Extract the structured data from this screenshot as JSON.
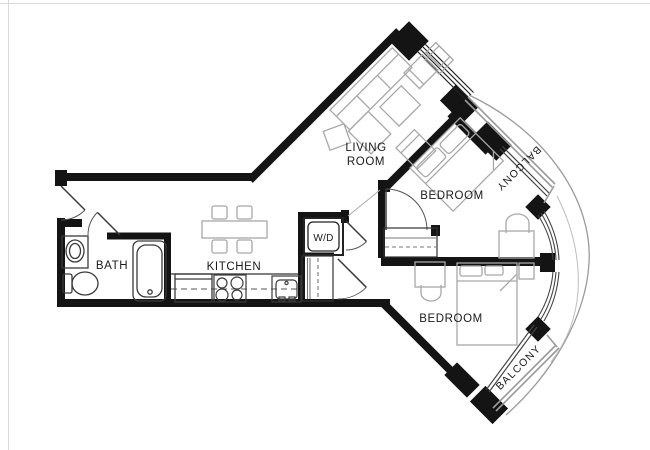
{
  "document": {
    "type": "apartment-floor-plan"
  },
  "labels": {
    "bath": "BATH",
    "kitchen": "KITCHEN",
    "washer_dryer": "W/D",
    "living_room_line1": "LIVING",
    "living_room_line2": "ROOM",
    "bedroom_upper": "BEDROOM",
    "bedroom_lower": "BEDROOM",
    "balcony_upper": "BALCONY",
    "balcony_lower": "BALCONY"
  },
  "colors": {
    "walls": "#141414",
    "fixtures": "#3a3a3a",
    "furniture": "#a8a8a8",
    "railing": "#9a9a9a",
    "closet_lines": "#777777",
    "background": "#ffffff",
    "label_text": "#1a1a1a",
    "page_border": "#d9d9d9"
  }
}
